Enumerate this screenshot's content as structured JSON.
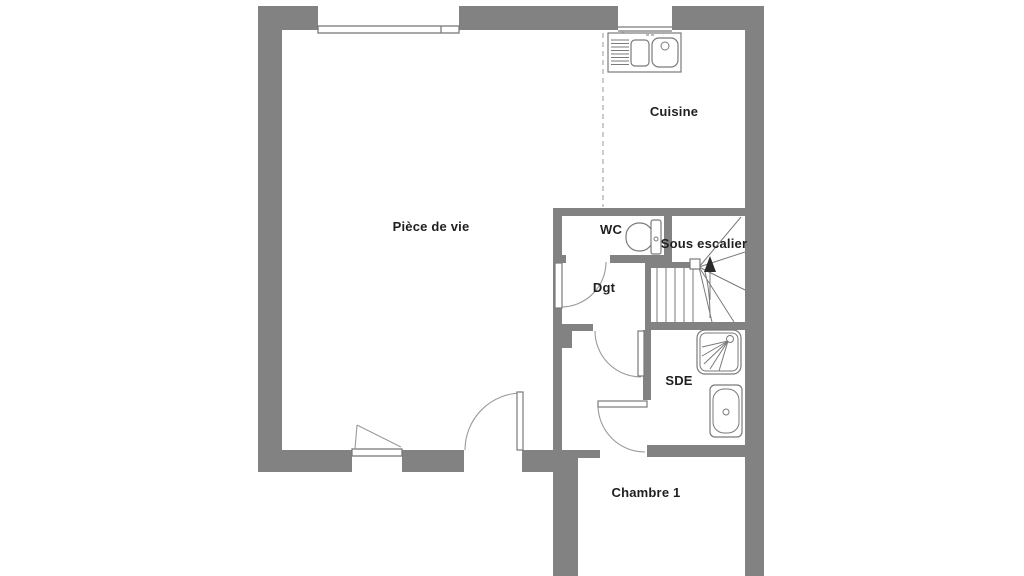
{
  "rooms": [
    {
      "id": "piece-de-vie",
      "label": "Pièce de vie"
    },
    {
      "id": "cuisine",
      "label": "Cuisine"
    },
    {
      "id": "wc",
      "label": "WC"
    },
    {
      "id": "sous-escalier",
      "label": "Sous escalier"
    },
    {
      "id": "dgt",
      "label": "Dgt"
    },
    {
      "id": "sde",
      "label": "SDE"
    },
    {
      "id": "chambre-1",
      "label": "Chambre 1"
    }
  ],
  "fixtures": [
    "kitchen-sink",
    "toilet",
    "staircase",
    "shower",
    "bathtub",
    "window-top-living",
    "window-top-kitchen",
    "window-bottom-living",
    "door-main",
    "door-wc-dgt",
    "door-vestibule",
    "door-chambre-1"
  ],
  "colors": {
    "wall": "#828282",
    "line": "#7a7a7a",
    "lightline": "#9a9a9a",
    "dash": "#aaaaaa",
    "text": "#1f1f1f",
    "background": "#ffffff"
  }
}
